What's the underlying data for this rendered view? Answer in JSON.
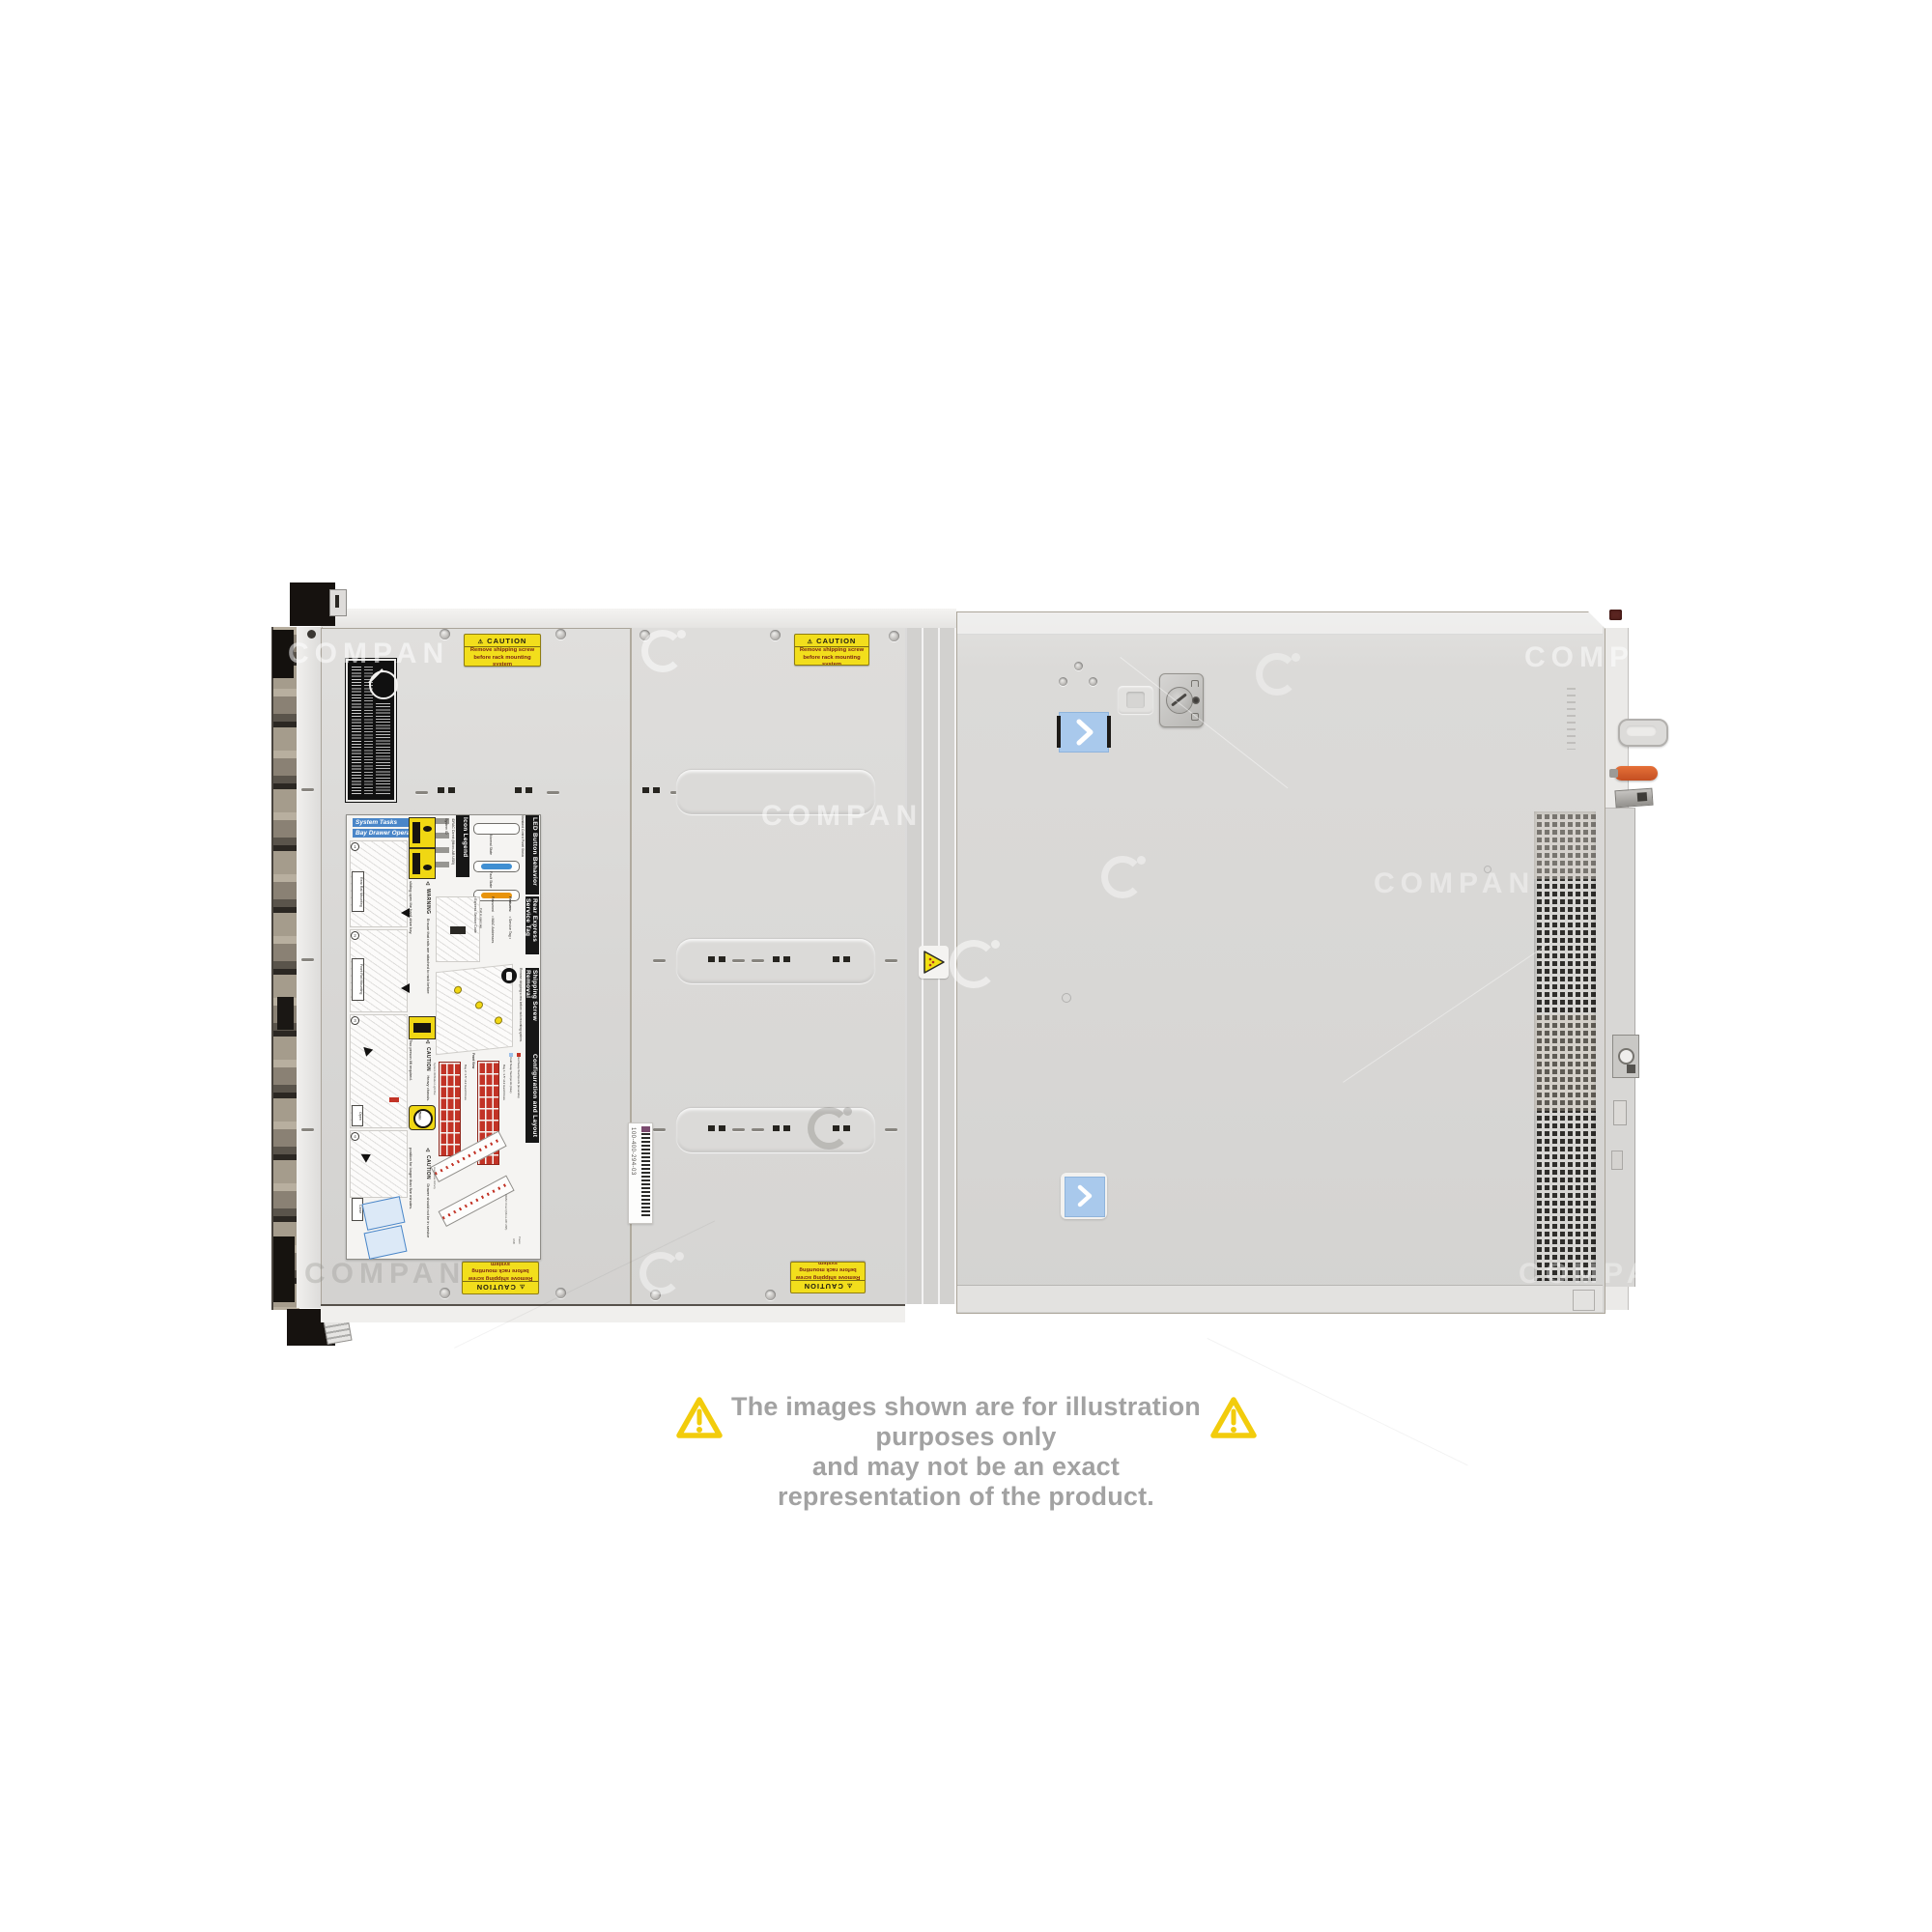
{
  "watermark": {
    "text": "COMPAN"
  },
  "stickers": {
    "caution": {
      "title": "CAUTION",
      "line1": "Remove shipping screw",
      "line2": "before rack mounting system"
    },
    "barcode": "100-400-294-03"
  },
  "service_label": {
    "system_tasks": "System Tasks",
    "bay_drawer_operation": "Bay Drawer Operation",
    "rear_rail_mounting": "Rear Rail Mounting",
    "front_rail_mounting": "Front Rail Mounting",
    "open": "Open",
    "close": "Close",
    "steps": [
      "1",
      "2",
      "3",
      "4"
    ],
    "warning_title": "WARNING",
    "warning_text": "Ensure that rails are attached to rack before sliding open the hard drive bay.",
    "caution_title": "CAUTION",
    "caution_heavy": "Heavy chassis. Two person lift required.",
    "five_min": "5min",
    "caution_drawer": "Drawer should not be in service position for longer than five minutes.",
    "icon_legend": {
      "title": "Icon Legend",
      "items": [
        "System ID",
        "iDRAC Direct (Micro-AB USB)"
      ]
    },
    "led_button": {
      "title": "LED Button Behavior",
      "subtitle": "Standard Control Panel Status",
      "normal": "Normal State",
      "fault": "Fault State"
    },
    "rear_express": {
      "title": "Rear Express Service Tag",
      "features_title": "Features:",
      "features": [
        "Service Tag",
        "Password",
        "MAC Addresses",
        "Express Service Code"
      ],
      "note": "Pull to open tag"
    },
    "shipping_screw": {
      "title": "Shipping Screw Removal",
      "text": "Remove shipping screw before rack mounting system."
    },
    "configuration": {
      "title": "Configuration and Layout",
      "front_view": "Front View",
      "legend_hot": "Hot Swap Touchpoints (terracotta)",
      "legend_cold": "Cold Swap Touchpoints (blue)",
      "bay1": "Bay 1: 3.5\" x12 Hard Drives",
      "bay2": "Bay 2: 3.5\" x12 Hard Drives",
      "annotations": [
        "System ID/Status Light Bar",
        "Hard Drive Activity",
        "iDRAC Direct (Micro-AB USB)",
        "USB",
        "Power"
      ]
    }
  },
  "disclaimer": {
    "line1": "The images shown are for illustration purposes only",
    "line2": "and may not be an exact representation of the product."
  },
  "colors": {
    "caution_yellow": "#F2DE1C",
    "sticker_blue": "#A9C9EC",
    "latch_orange": "#D65A2B",
    "led_normal_blue": "#3F8FD2",
    "led_fault_orange": "#E8930C",
    "touchpoint_red": "#C23326",
    "disclaimer_yellow": "#F2CC0C",
    "disclaimer_text": "#A2A2A2"
  }
}
